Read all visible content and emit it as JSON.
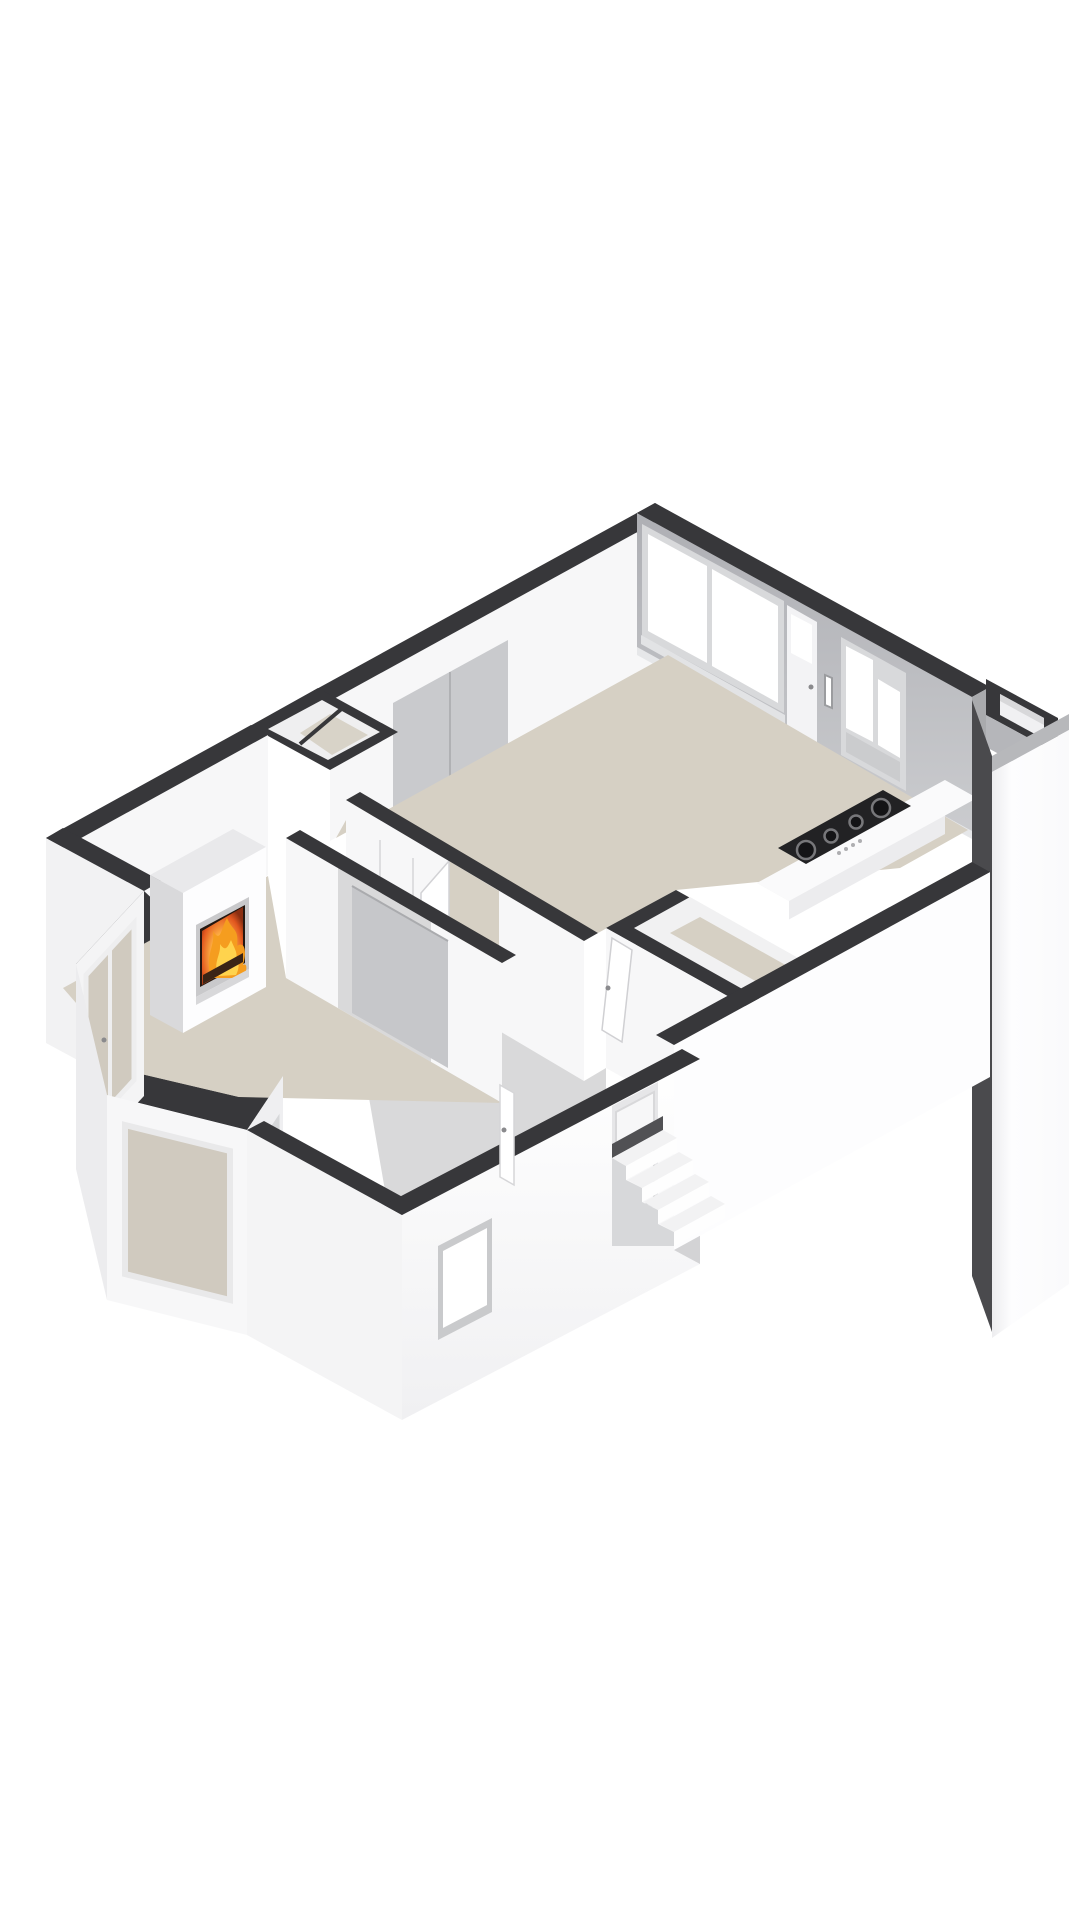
{
  "meta": {
    "title": "3D Floor Plan",
    "scene_type": "isometric-3d-floorplan-render",
    "background": "#ffffff"
  },
  "palette": {
    "cap": "#37373a",
    "wall_white": "#f7f7f8",
    "wall_bright": "#fdfdfe",
    "wall_shade": "#ececee",
    "gray_face": "#b5b6ba",
    "gray_light": "#c9cacd",
    "window_frame": "#d8d9db",
    "glass_white": "#ffffff",
    "floor_beige": "#d6d0c4",
    "floor_gray": "#d9d9da",
    "counter_top": "#fafafb",
    "cooktop_black": "#222224",
    "burner_ring": "#77777a",
    "fire_core": "#ffd34d",
    "fire_mid": "#f59d1f",
    "fire_deep": "#e2571f",
    "firebox_dark": "#241710",
    "annex_seam": "#4a4a4d",
    "panel_gray": "#c6c7ca"
  },
  "scene": {
    "rooms": [
      {
        "name": "living-room",
        "floor": "beige",
        "features": [
          "fireplace-with-burning-fire",
          "bay-window",
          "french-door",
          "sliding-door-opening"
        ]
      },
      {
        "name": "kitchen-living",
        "floor": "beige",
        "features": [
          "kitchen-counter",
          "gas-cooktop-4-burners",
          "large-window",
          "glazed-door",
          "letterbox-door",
          "double-window"
        ]
      },
      {
        "name": "hallway",
        "floor": "gray",
        "features": [
          "built-in-closet",
          "interior-doors"
        ]
      },
      {
        "name": "bathroom-core",
        "floor": "beige",
        "features": [
          "door-ajar"
        ]
      },
      {
        "name": "entry",
        "floor": "gray",
        "features": [
          "entrance-door",
          "exterior-stairs",
          "small-window"
        ]
      }
    ],
    "exterior": [
      "dark-wall-caps",
      "white-exterior-faces",
      "chimney-shaft-open-top",
      "right-annex-wall",
      "storage-nook"
    ]
  }
}
